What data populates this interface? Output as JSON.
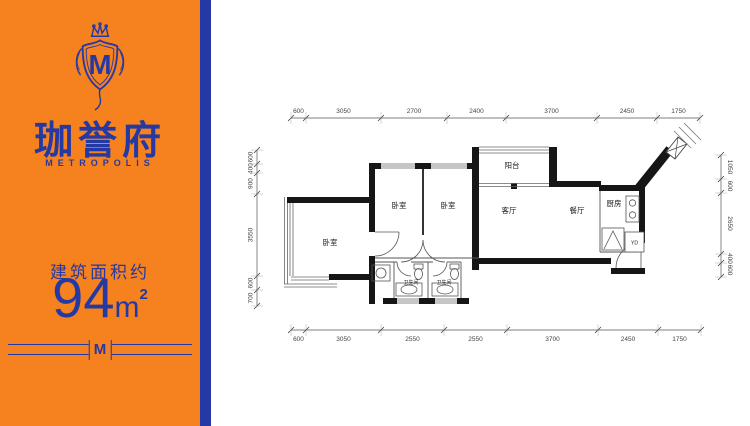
{
  "colors": {
    "panel_orange": "#F5811F",
    "brand_blue": "#2539A4",
    "wall_black": "#161616"
  },
  "brand": {
    "emblem_letter": "M",
    "name_cn": "珈誉府",
    "name_en": "METROPOLIS",
    "area_label": "建筑面积约",
    "area_value": "94",
    "area_unit": "m",
    "area_sup": "2",
    "divider_monogram": "M"
  },
  "floorplan": {
    "rooms": {
      "bedroom_left": "卧室",
      "bedroom_1": "卧室",
      "bedroom_2": "卧室",
      "balcony": "阳台",
      "living": "客厅",
      "dining": "餐厅",
      "kitchen": "厨房",
      "bath_1": "卫生间",
      "bath_2": "卫生间",
      "flue": "YD"
    },
    "dims_top": [
      "600",
      "3050",
      "2700",
      "2400",
      "3700",
      "2450",
      "1750"
    ],
    "dims_bottom": [
      "600",
      "3050",
      "2550",
      "2550",
      "3700",
      "2450",
      "1750"
    ],
    "dims_left": [
      "600",
      "400",
      "900",
      "3550",
      "600",
      "700"
    ],
    "dims_right": [
      "1050",
      "600",
      "2650",
      "400",
      "600"
    ]
  }
}
